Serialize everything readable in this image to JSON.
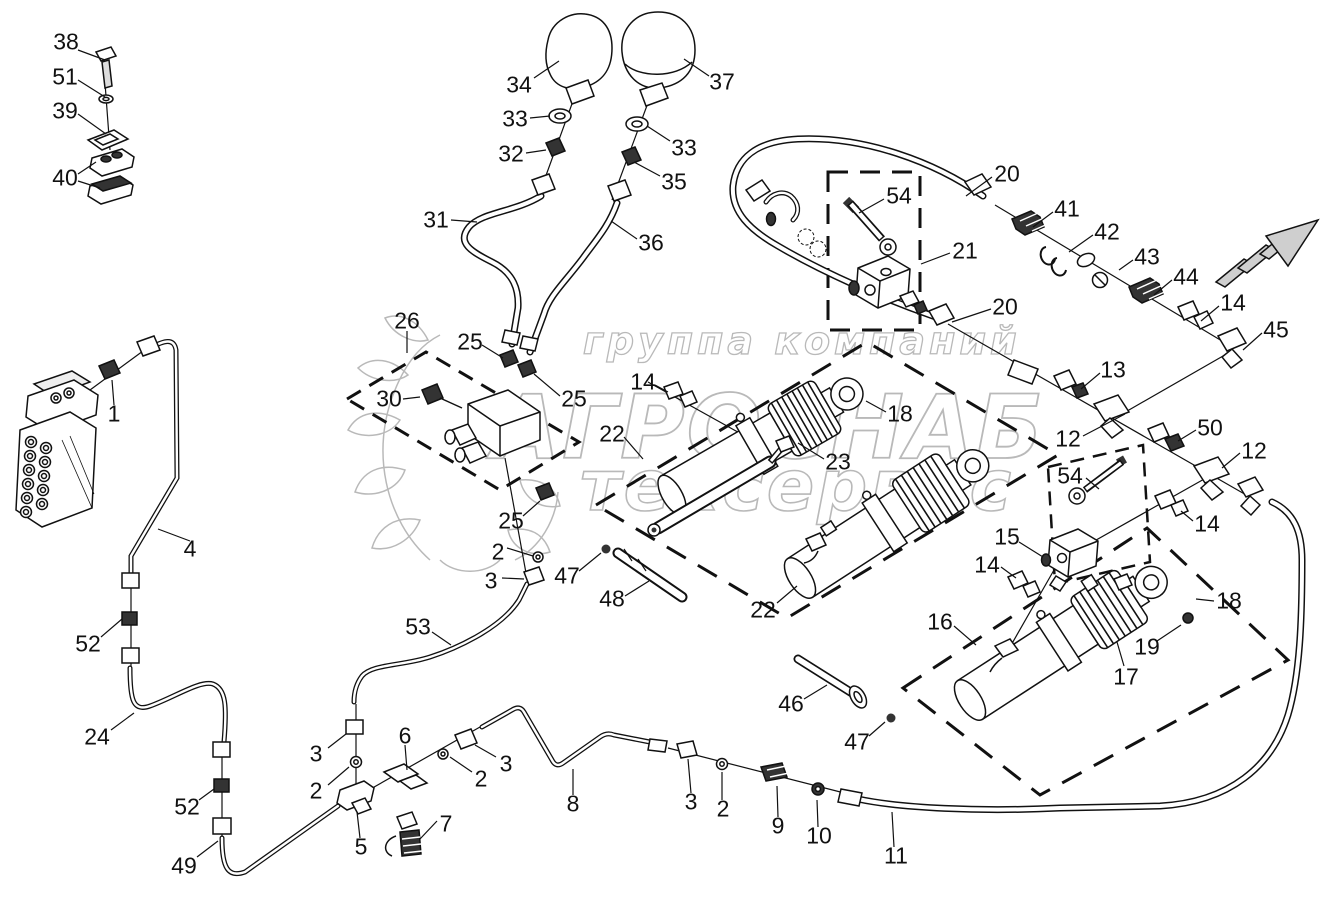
{
  "watermark": {
    "line1": "группа компаний",
    "brand": "АГРОСНАБ",
    "line3": "техсервис"
  },
  "callouts": [
    "38",
    "51",
    "39",
    "40",
    "34",
    "37",
    "33",
    "32",
    "33",
    "35",
    "31",
    "36",
    "20",
    "41",
    "42",
    "43",
    "44",
    "14",
    "45",
    "54",
    "21",
    "26",
    "25",
    "25",
    "30",
    "25",
    "2",
    "3",
    "14",
    "22",
    "18",
    "23",
    "20",
    "13",
    "12",
    "50",
    "12",
    "54",
    "14",
    "15",
    "14",
    "16",
    "18",
    "19",
    "17",
    "47",
    "48",
    "22",
    "46",
    "47",
    "53",
    "4",
    "52",
    "24",
    "52",
    "49",
    "3",
    "2",
    "6",
    "5",
    "7",
    "2",
    "3",
    "8",
    "3",
    "2",
    "9",
    "10",
    "11",
    "1"
  ]
}
